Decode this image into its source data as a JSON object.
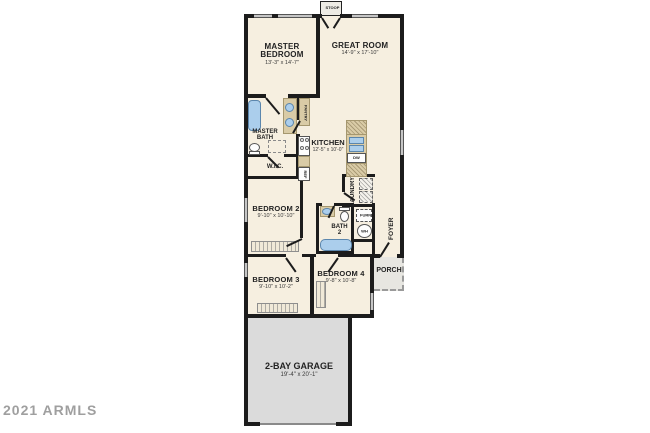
{
  "watermark": "2021 ARMLS",
  "colors": {
    "floor": "#f6efe0",
    "wall": "#1c1c1c",
    "garage_floor": "#dbdbdb",
    "porch_floor": "#e7e6e1",
    "cabinet": "#d9cba6",
    "fixture_blue": "#abceec",
    "watermark_gray": "#8f8f8f"
  },
  "rooms": {
    "stoop": {
      "label": "STOOP"
    },
    "master_bedroom": {
      "label": "MASTER BEDROOM",
      "dims": "13'-3\" x 14'-7\""
    },
    "great_room": {
      "label": "GREAT ROOM",
      "dims": "14'-9\" x 17'-10\""
    },
    "master_bath": {
      "label": "MASTER BATH"
    },
    "wic": {
      "label": "W.I.C."
    },
    "pantry": {
      "label": "PANTRY"
    },
    "kitchen": {
      "label": "KITCHEN",
      "dims": "12'-5\" x 10'-0\""
    },
    "bedroom_2": {
      "label": "BEDROOM 2",
      "dims": "9'-10\" x 10'-10\""
    },
    "laundry": {
      "label": "LAUNDRY"
    },
    "bath_2": {
      "label": "BATH 2"
    },
    "foyer": {
      "label": "FOYER"
    },
    "porch": {
      "label": "PORCH"
    },
    "bedroom_3": {
      "label": "BEDROOM 3",
      "dims": "9'-10\" x 10'-2\""
    },
    "bedroom_4": {
      "label": "BEDROOM 4",
      "dims": "9'-8\" x 10'-8\""
    },
    "garage": {
      "label": "2-BAY GARAGE",
      "dims": "19'-4\" x 20'-1\""
    }
  },
  "fixtures": {
    "ref": "REF",
    "dw": "DW",
    "furn": "FURN",
    "wh": "WH"
  }
}
